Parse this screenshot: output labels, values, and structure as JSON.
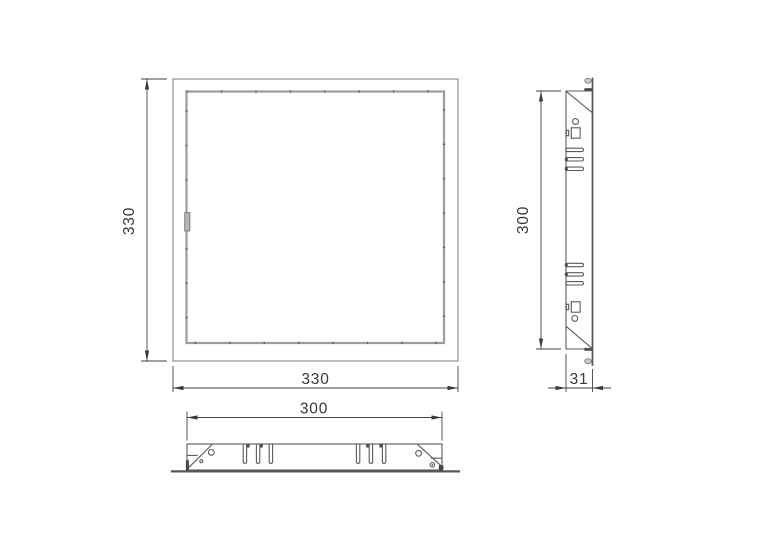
{
  "page": {
    "background_color": "#ffffff",
    "description": "CAD technical drawing of a square access panel shown in front, side and bottom orthographic views"
  },
  "drawing": {
    "colors": {
      "outline": "#5a5a5a",
      "thin_outline": "#8f8f8f",
      "panel_edge": "#9d9d9d",
      "dimension": "#3f3f3f",
      "handle_fill": "#b5b5b5",
      "detail_fill": "#474747"
    },
    "views": {
      "front": {
        "name": "front-view",
        "dimensions": {
          "height": "330",
          "width": "330"
        }
      },
      "side": {
        "name": "side-view",
        "dimensions": {
          "height": "300",
          "depth": "31"
        }
      },
      "bottom": {
        "name": "bottom-view",
        "dimensions": {
          "width": "300"
        }
      }
    }
  }
}
